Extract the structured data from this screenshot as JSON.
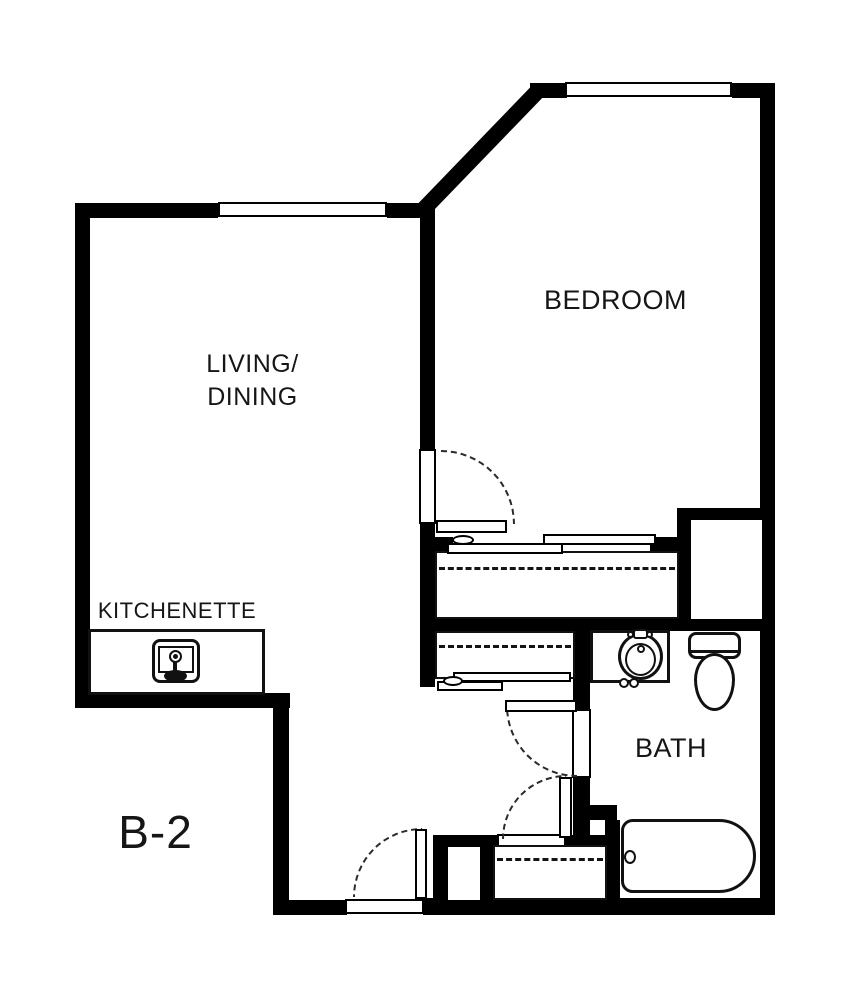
{
  "unit": {
    "label": "B-2"
  },
  "rooms": {
    "living": {
      "line1": "LIVING/",
      "line2": "DINING"
    },
    "bedroom": {
      "label": "BEDROOM"
    },
    "kitchenette": {
      "label": "KITCHENETTE"
    },
    "bath": {
      "label": "BATH"
    }
  },
  "colors": {
    "walls": "#000000",
    "background": "#ffffff",
    "text": "#161616"
  }
}
